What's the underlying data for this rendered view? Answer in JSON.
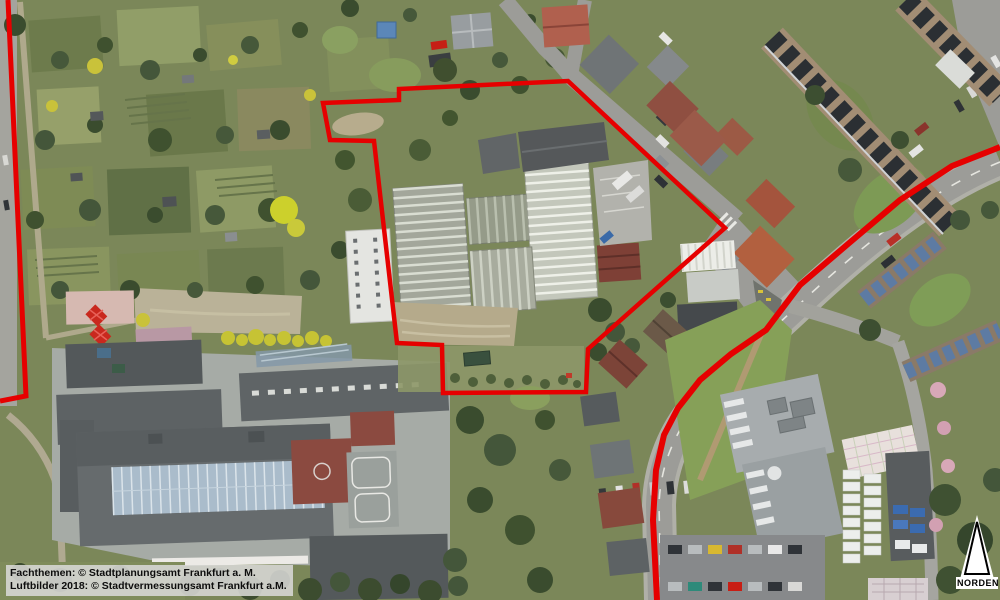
{
  "map": {
    "attribution": {
      "line1": "Fachthemen: © Stadtplanungsamt Frankfurt a. M.",
      "line2": "Luftbilder 2018: © Stadtvermessungsamt Frankfurt a.M."
    },
    "north_arrow": {
      "label": "NORDEN"
    },
    "overlay": {
      "color": "#e60000",
      "widths": {
        "boundary": 4.5,
        "left": 5,
        "road": 6
      },
      "boundary_polygon": [
        [
          323,
          103
        ],
        [
          399,
          100
        ],
        [
          399,
          89
        ],
        [
          568,
          81
        ],
        [
          725,
          228
        ],
        [
          675,
          272
        ],
        [
          588,
          349
        ],
        [
          586,
          392
        ],
        [
          443,
          393
        ],
        [
          442,
          345
        ],
        [
          397,
          343
        ],
        [
          374,
          141
        ],
        [
          330,
          140
        ]
      ],
      "left_boundary_line": [
        [
          8,
          0
        ],
        [
          26,
          396
        ],
        [
          0,
          401
        ]
      ],
      "road_line": [
        [
          1000,
          147
        ],
        [
          952,
          166
        ],
        [
          900,
          200
        ],
        [
          848,
          244
        ],
        [
          800,
          285
        ],
        [
          766,
          330
        ],
        [
          731,
          354
        ],
        [
          700,
          380
        ],
        [
          678,
          408
        ],
        [
          664,
          435
        ],
        [
          656,
          470
        ],
        [
          653,
          520
        ],
        [
          655,
          560
        ],
        [
          657,
          600
        ]
      ]
    }
  }
}
